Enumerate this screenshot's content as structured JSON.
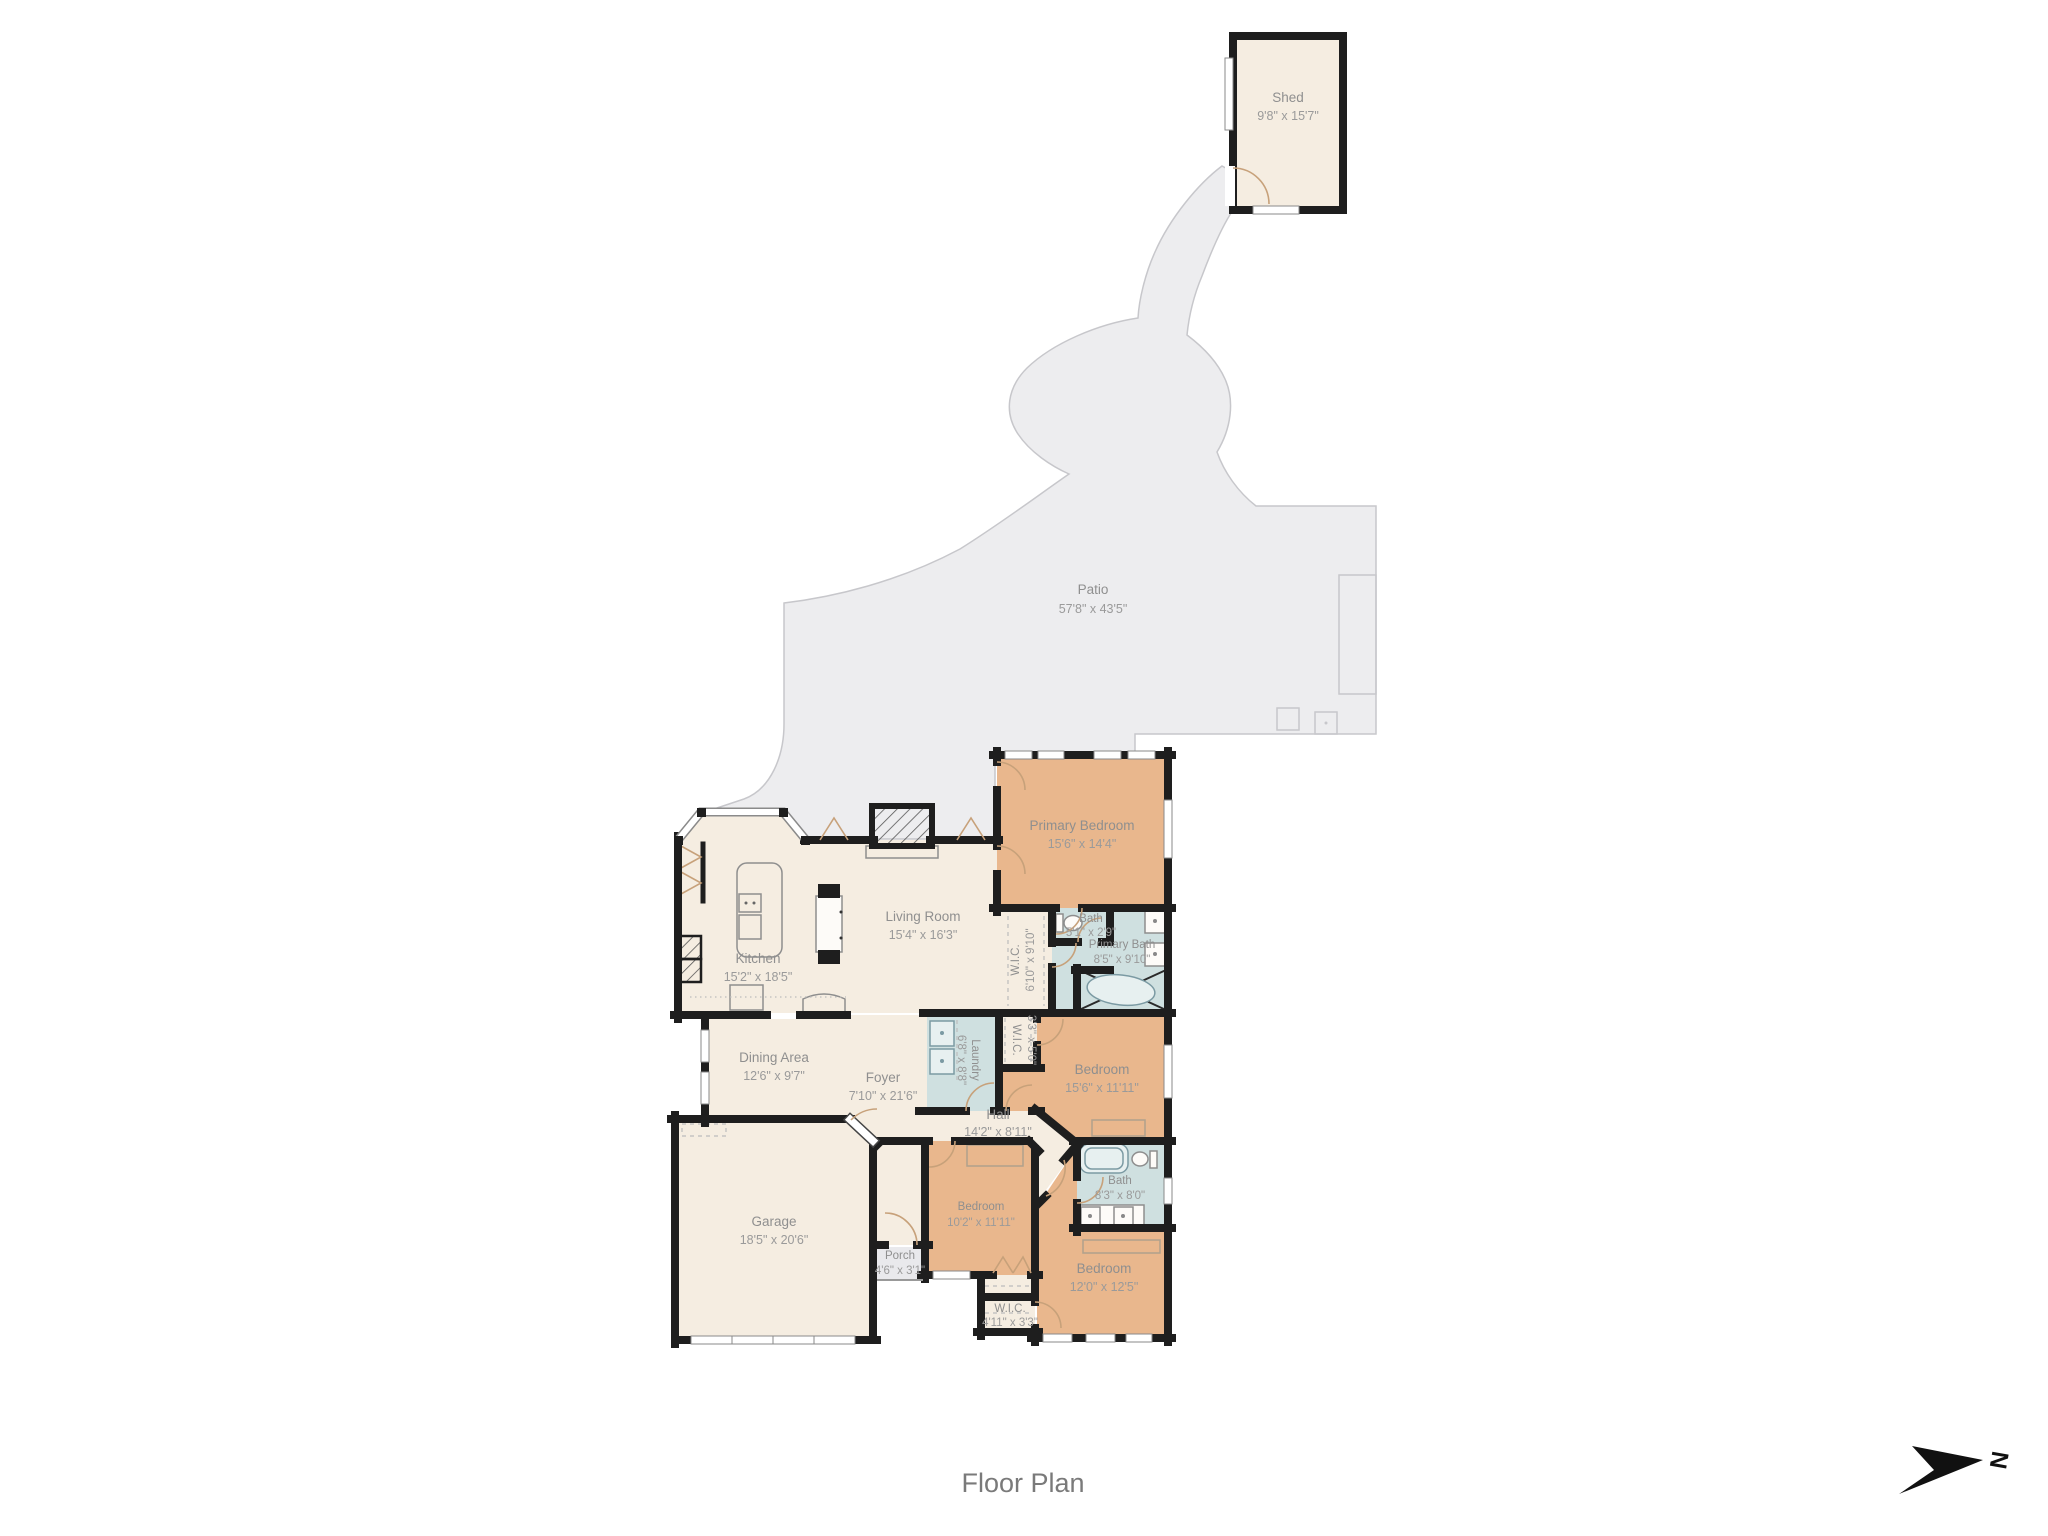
{
  "caption": "Floor Plan",
  "north_indicator": {
    "label": "N"
  },
  "colors": {
    "background": "#ffffff",
    "walls": "#1e1e1e",
    "floor_common": "#f5ede1",
    "floor_bedroom": "#e9b78d",
    "floor_bath": "#cfe0e0",
    "patio": "#ededef",
    "label_text": "#8f8f8f"
  },
  "rooms": {
    "shed": {
      "name": "Shed",
      "dims": "9'8\" x 15'7\""
    },
    "patio": {
      "name": "Patio",
      "dims": "57'8\" x 43'5\""
    },
    "primary_bedroom": {
      "name": "Primary Bedroom",
      "dims": "15'6\" x 14'4\""
    },
    "living_room": {
      "name": "Living Room",
      "dims": "15'4\" x 16'3\""
    },
    "kitchen": {
      "name": "Kitchen",
      "dims": "15'2\" x 18'5\""
    },
    "primary_wic": {
      "name": "W.I.C.",
      "dims": "6'10\" x 9'10\""
    },
    "water_closet": {
      "name": "Bath",
      "dims": "5'1\" x 2'9\""
    },
    "primary_bath": {
      "name": "Primary Bath",
      "dims": "8'5\" x 9'10\""
    },
    "dining_area": {
      "name": "Dining Area",
      "dims": "12'6\" x 9'7\""
    },
    "foyer": {
      "name": "Foyer",
      "dims": "7'10\" x 21'6\""
    },
    "laundry": {
      "name": "Laundry",
      "dims": "6'8\" x 8'8\""
    },
    "hall_wic": {
      "name": "W.I.C.",
      "dims": "3'3\" x 5'0\""
    },
    "bedroom_2": {
      "name": "Bedroom",
      "dims": "15'6\" x 11'11\""
    },
    "hall": {
      "name": "Hall",
      "dims": "14'2\" x 8'11\""
    },
    "bath_2": {
      "name": "Bath",
      "dims": "8'3\" x 8'0\""
    },
    "garage": {
      "name": "Garage",
      "dims": "18'5\" x 20'6\""
    },
    "bedroom_1": {
      "name": "Bedroom",
      "dims": "10'2\" x 11'11\""
    },
    "porch": {
      "name": "Porch",
      "dims": "4'6\" x 3'1\""
    },
    "bedroom_3": {
      "name": "Bedroom",
      "dims": "12'0\" x 12'5\""
    },
    "bedroom_wic": {
      "name": "W.I.C.",
      "dims": "4'11\" x 3'3\""
    }
  }
}
